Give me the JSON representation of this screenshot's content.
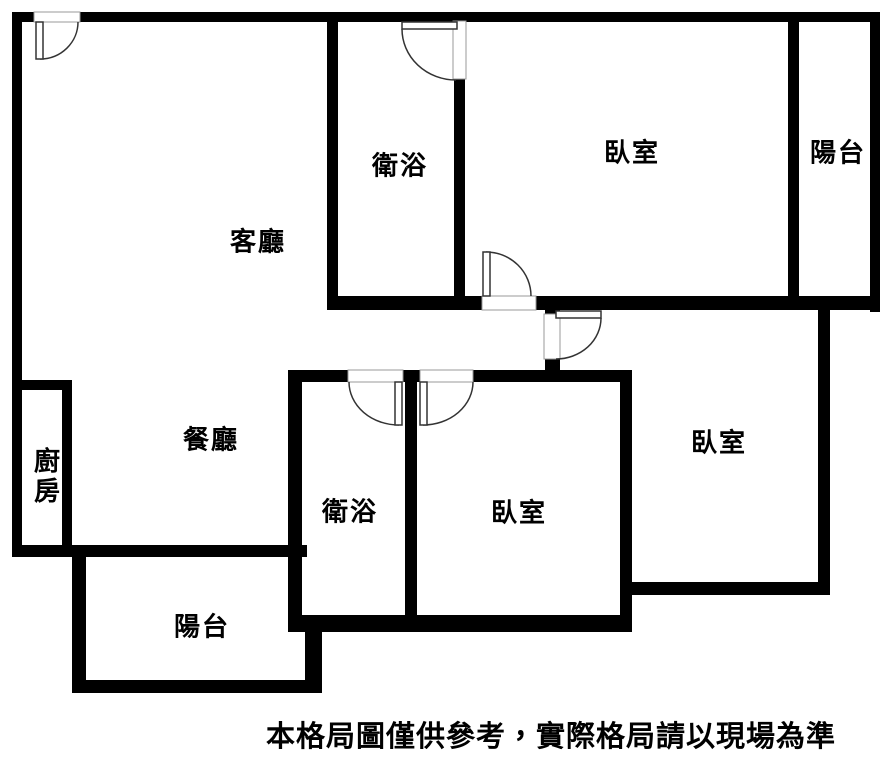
{
  "plan_title": "apartment-floor-plan",
  "colors": {
    "wall": "#000000",
    "background": "#ffffff",
    "door_arc": "#333333",
    "door_leaf_fill": "#ffffff",
    "door_leaf_stroke": "#333333",
    "threshold_fill": "#ffffff",
    "threshold_stroke": "#999999",
    "text": "#000000"
  },
  "labels": {
    "living": {
      "text": "客廳",
      "x": 258,
      "y": 240
    },
    "bath_top": {
      "text": "衛浴",
      "x": 400,
      "y": 164
    },
    "bed_top": {
      "text": "臥室",
      "x": 632,
      "y": 151
    },
    "balcony_top": {
      "text": "陽台",
      "x": 838,
      "y": 151
    },
    "dining": {
      "text": "餐廳",
      "x": 211,
      "y": 438
    },
    "kitchen": {
      "text": "廚房",
      "x": 46,
      "y": 477
    },
    "bath_mid": {
      "text": "衛浴",
      "x": 350,
      "y": 510
    },
    "bed_mid": {
      "text": "臥室",
      "x": 519,
      "y": 511
    },
    "bed_right": {
      "text": "臥室",
      "x": 719,
      "y": 441
    },
    "balcony_bottom": {
      "text": "陽台",
      "x": 202,
      "y": 625
    }
  },
  "disclaimer": {
    "text": "本格局圖僅供參考，實際格局請以現場為準",
    "x": 551,
    "y": 734
  },
  "plan": {
    "width": 889,
    "height": 759,
    "walls": [
      [
        12,
        12,
        23,
        10
      ],
      [
        80,
        12,
        800,
        10
      ],
      [
        12,
        12,
        10,
        545
      ],
      [
        870,
        12,
        10,
        300
      ],
      [
        327,
        12,
        11,
        296
      ],
      [
        454,
        78,
        11,
        230
      ],
      [
        788,
        12,
        11,
        296
      ],
      [
        327,
        296,
        156,
        14
      ],
      [
        535,
        296,
        345,
        14
      ],
      [
        545,
        310,
        15,
        6
      ],
      [
        545,
        358,
        15,
        14
      ],
      [
        818,
        310,
        12,
        285
      ],
      [
        632,
        582,
        198,
        13
      ],
      [
        620,
        370,
        12,
        262
      ],
      [
        288,
        370,
        60,
        12
      ],
      [
        403,
        370,
        17,
        12
      ],
      [
        473,
        370,
        147,
        12
      ],
      [
        288,
        370,
        14,
        260
      ],
      [
        405,
        382,
        12,
        250
      ],
      [
        288,
        615,
        344,
        17
      ],
      [
        12,
        380,
        60,
        10
      ],
      [
        62,
        380,
        10,
        165
      ],
      [
        12,
        545,
        295,
        12
      ],
      [
        72,
        545,
        14,
        148
      ],
      [
        72,
        680,
        250,
        13
      ],
      [
        305,
        630,
        17,
        63
      ]
    ],
    "doors": [
      {
        "name": "entry-door",
        "threshold": [
          34,
          12,
          46,
          10
        ],
        "leaf": [
          36,
          22,
          7,
          37
        ],
        "arc": "M78,22 A38,37 0 0 1 40,59"
      },
      {
        "name": "bathroom-top-door",
        "threshold": [
          453,
          21,
          13,
          58
        ],
        "leaf": [
          402,
          22,
          55,
          7
        ],
        "arc": "M402,29 A54,51 0 0 0 456,80"
      },
      {
        "name": "bedroom-top-door",
        "threshold": [
          482,
          296,
          54,
          14
        ],
        "leaf": [
          483,
          252,
          7,
          44
        ],
        "arc": "M486,252 A45,44 0 0 1 531,296"
      },
      {
        "name": "bedroom-right-door",
        "threshold": [
          544,
          314,
          16,
          45
        ],
        "leaf": [
          556,
          311,
          45,
          7
        ],
        "arc": "M601,318 A45,41 0 0 1 556,359"
      },
      {
        "name": "bathroom-middle-door",
        "threshold": [
          348,
          370,
          55,
          12
        ],
        "leaf": [
          395,
          382,
          7,
          43
        ],
        "arc": "M349,382 A50,43 0 0 0 399,425"
      },
      {
        "name": "bedroom-middle-door",
        "threshold": [
          420,
          370,
          53,
          12
        ],
        "leaf": [
          420,
          382,
          7,
          43
        ],
        "arc": "M473,382 A50,43 0 0 1 423,425"
      }
    ]
  }
}
